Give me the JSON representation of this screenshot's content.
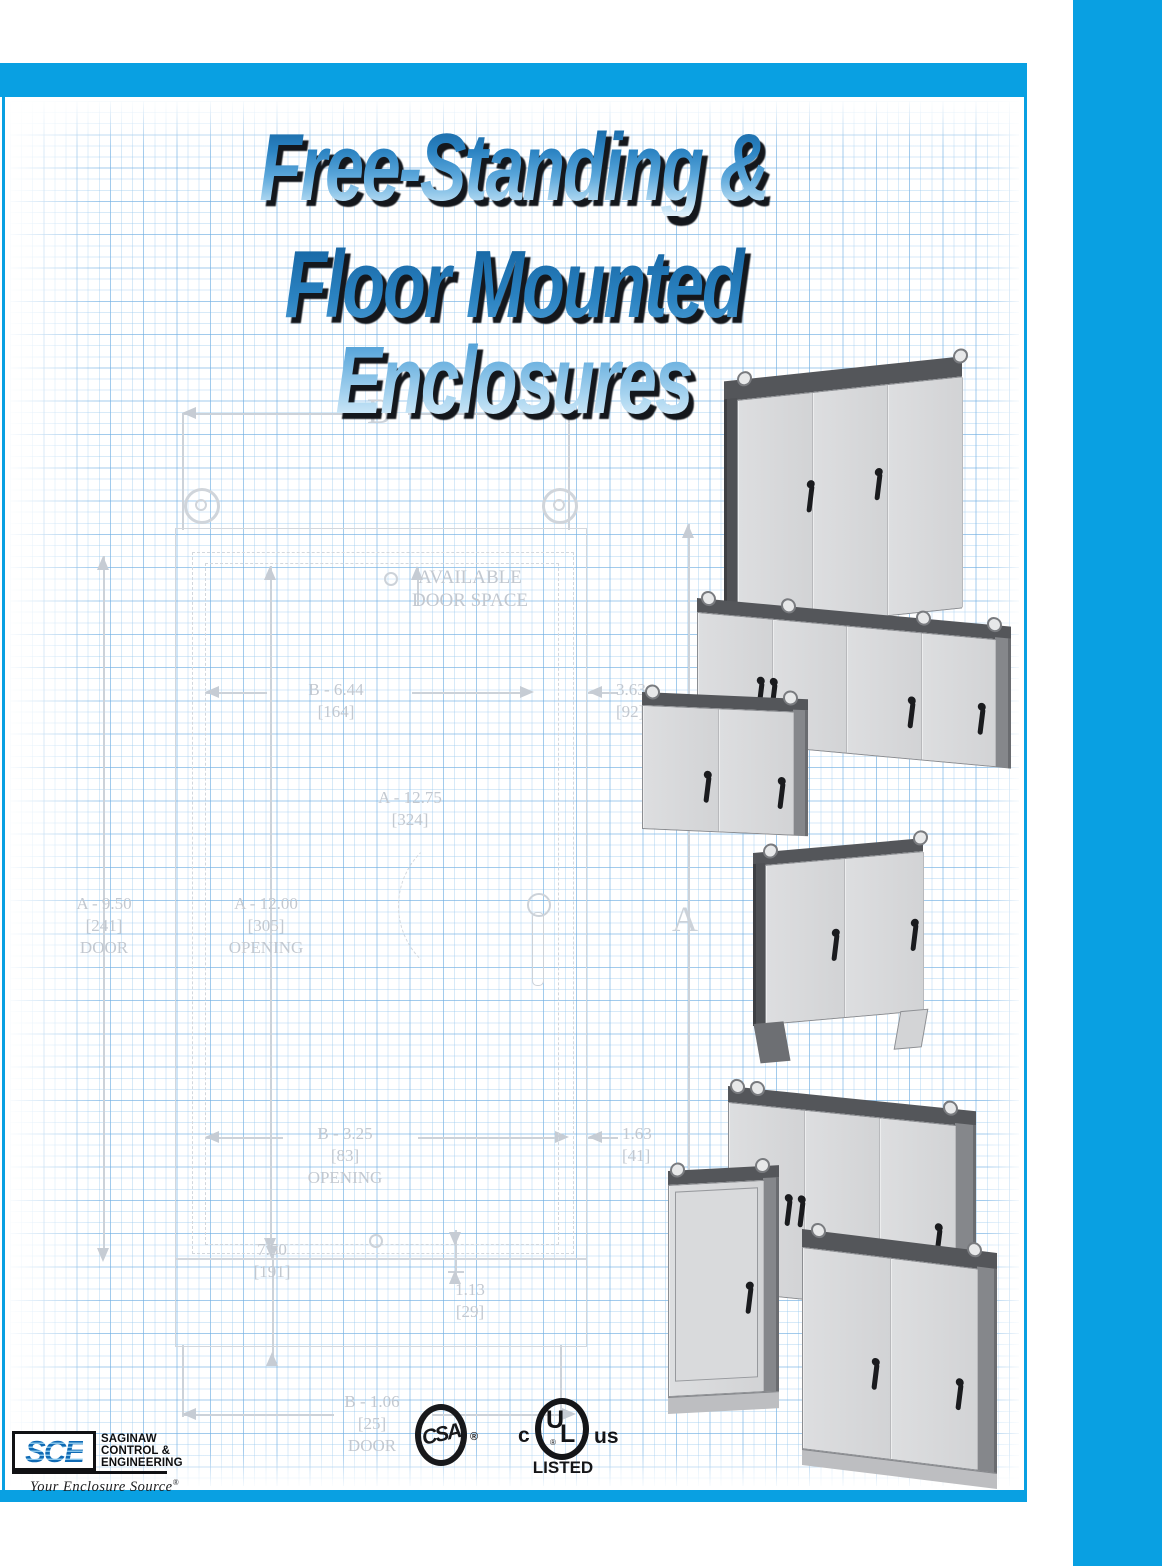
{
  "colors": {
    "accent_blue": "#09a0e2",
    "title_gradient_top": "#14629f",
    "title_gradient_bottom": "#e4f3fc",
    "drawing_line": "#ccd2d9",
    "enclosure_body": "#d7d8da",
    "enclosure_dark_side": "#54565a"
  },
  "title": {
    "line1": "Free-Standing &",
    "line2": "Floor Mounted Enclosures"
  },
  "drawing": {
    "labels": {
      "b_letter": "B",
      "a_letter": "A",
      "available_1": "AVAILABLE",
      "available_2": "DOOR SPACE",
      "b644_1": "B - 6.44",
      "b644_2": "[164]",
      "d363_1": "3.63",
      "d363_2": "[92]",
      "a1275_1": "A - 12.75",
      "a1275_2": "[324]",
      "a950_1": "A - 9.50",
      "a950_2": "[241]",
      "a950_3": "DOOR",
      "a1200_1": "A - 12.00",
      "a1200_2": "[305]",
      "a1200_3": "OPENING",
      "b325_1": "B - 3.25",
      "b325_2": "[83]",
      "b325_3": "OPENING",
      "d163_1": "1.63",
      "d163_2": "[41]",
      "d750_1": "7.50",
      "d750_2": "[191]",
      "d113_1": "1.13",
      "d113_2": "[29]",
      "b106_1": "B - 1.06",
      "b106_2": "[25]",
      "b106_3": "DOOR"
    }
  },
  "enclosures": [
    {
      "name": "three-door-wide",
      "doors": 3,
      "lifting_eyes": true
    },
    {
      "name": "four-door-wide",
      "doors": 4,
      "lifting_eyes": true
    },
    {
      "name": "two-door-wide",
      "doors": 2,
      "lifting_eyes": true
    },
    {
      "name": "two-door-floor-stands",
      "doors": 2,
      "lifting_eyes": true,
      "floor_stands": true
    },
    {
      "name": "three-door-rear",
      "doors": 3,
      "lifting_eyes": true
    },
    {
      "name": "single-door-tall",
      "doors": 1,
      "lifting_eyes": true
    },
    {
      "name": "two-door-front",
      "doors": 2,
      "lifting_eyes": true
    }
  ],
  "logos": {
    "sce": {
      "letters": "SCE",
      "org_line1": "SAGINAW",
      "org_line2": "CONTROL &",
      "org_line3": "ENGINEERING",
      "tagline": "Your Enclosure Source",
      "registered": "®"
    },
    "csa": {
      "letters": "CSA",
      "registered": "®"
    },
    "ul": {
      "c": "c",
      "u": "U",
      "l": "L",
      "us": "us",
      "listed": "LISTED",
      "registered": "®"
    }
  }
}
